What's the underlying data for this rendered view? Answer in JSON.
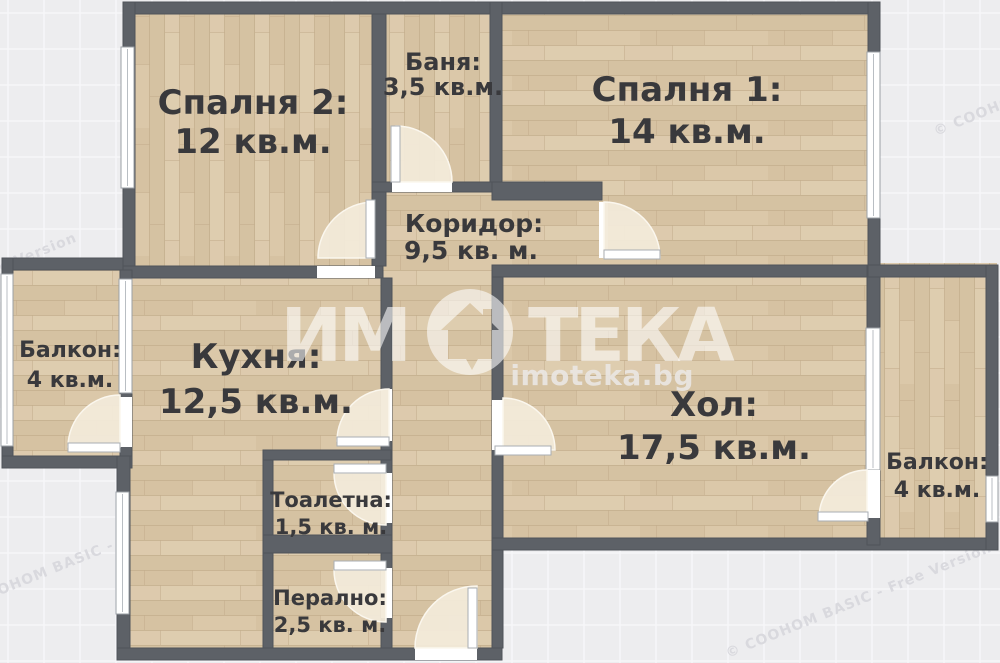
{
  "plan": {
    "rooms": {
      "bedroom2": {
        "label": "Спалня 2:",
        "area": "12 кв.м."
      },
      "bathroom": {
        "label": "Баня:",
        "area": "3,5 кв.м."
      },
      "bedroom1": {
        "label": "Спалня 1:",
        "area": "14 кв.м."
      },
      "corridor": {
        "label": "Коридор:",
        "area": "9,5 кв. м."
      },
      "balcony_left": {
        "label": "Балкон:",
        "area": "4 кв.м."
      },
      "kitchen": {
        "label": "Кухня:",
        "area": "12,5 кв.м."
      },
      "toilet": {
        "label": "Тоалетна:",
        "area": "1,5 кв. м."
      },
      "laundry": {
        "label": "Перално:",
        "area": "2,5 кв. м."
      },
      "living_room": {
        "label": "Хол:",
        "area": "17,5 кв.м."
      },
      "balcony_right": {
        "label": "Балкон:",
        "area": "4 кв.м."
      }
    }
  },
  "branding": {
    "logo_text_left": "ИМ",
    "logo_text_right": "ТЕКА",
    "logo_icon": "house-in-circle-icon",
    "website": "imoteka.bg"
  },
  "watermark": {
    "license_text": "© COOHOM BASIC - Free Version"
  },
  "colors": {
    "background": "#ededef",
    "grid_line": "#f6f6f9",
    "wall": "#5d6167",
    "floor": "#d9c6a8",
    "floor_seam": "#c3ad8c",
    "door_swing": "#f2ead9",
    "label_text": "#39393c",
    "watermark_gray": "#d9d9de",
    "logo_white": "rgba(255,255,255,0.58)"
  }
}
